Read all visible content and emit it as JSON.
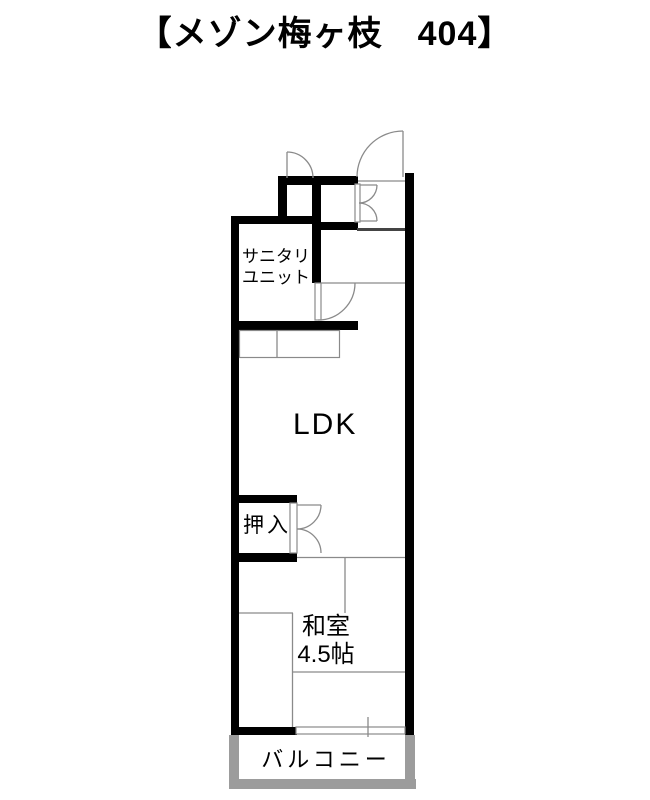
{
  "title": "【メゾン梅ヶ枝　404】",
  "rooms": {
    "sanitary_line1": "サニタリ",
    "sanitary_line2": "ユニット",
    "ldk": "LDK",
    "oshiire": "押入",
    "washitsu_name": "和室",
    "washitsu_size": "4.5帖",
    "balcony": "バルコニー"
  },
  "colors": {
    "wall": "#000000",
    "thin_line": "#8a8a8a",
    "balcony_wall": "#9c9c9c",
    "background": "#ffffff",
    "text": "#000000",
    "step_line": "#444444"
  }
}
